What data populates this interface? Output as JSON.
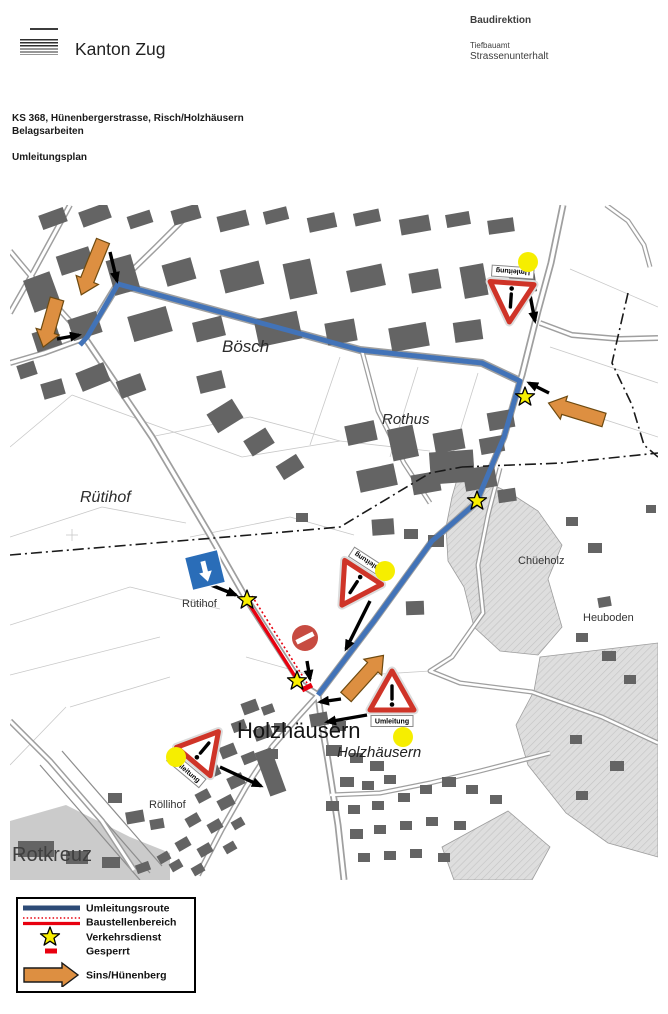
{
  "header": {
    "canton": "Kanton Zug",
    "department": "Baudirektion",
    "office_line1": "Tiefbauamt",
    "office_line2": "Strassenunterhalt"
  },
  "title": {
    "line1": "KS 368, Hünenbergerstrasse, Risch/Holzhäusern",
    "line2": "Belagsarbeiten",
    "subtitle": "Umleitungsplan"
  },
  "map": {
    "board_text": "Umleitung",
    "colors": {
      "route_blue": "#4273b8",
      "signal_red": "#e8000f",
      "triangle_red": "#cf3428",
      "no_entry_red": "#c74b41",
      "star_yellow": "#f9ef00",
      "dot_yellow": "#f6ee00",
      "arrow_orange": "#dd8f41",
      "building_gray": "#646464"
    },
    "place_labels": [
      {
        "text": "Bösch",
        "x": 212,
        "y": 147,
        "size": 17,
        "italic": true,
        "color": "#2b2b2b"
      },
      {
        "text": "Rothus",
        "x": 372,
        "y": 219,
        "size": 15,
        "italic": true,
        "color": "#2b2b2b"
      },
      {
        "text": "Rütihof",
        "x": 70,
        "y": 297,
        "size": 16,
        "italic": true,
        "color": "#2b2b2b"
      },
      {
        "text": "Rütihof",
        "x": 172,
        "y": 402,
        "size": 11,
        "italic": false,
        "color": "#333333"
      },
      {
        "text": "Chüeholz",
        "x": 508,
        "y": 359,
        "size": 11,
        "italic": false,
        "color": "#333333"
      },
      {
        "text": "Heuboden",
        "x": 573,
        "y": 416,
        "size": 11,
        "italic": false,
        "color": "#333333"
      },
      {
        "text": "Holzhäusern",
        "x": 227,
        "y": 533,
        "size": 22,
        "italic": false,
        "color": "#141414"
      },
      {
        "text": "Holzhäusern",
        "x": 327,
        "y": 552,
        "size": 15,
        "italic": true,
        "color": "#222222"
      },
      {
        "text": "Röllihof",
        "x": 139,
        "y": 603,
        "size": 11,
        "italic": false,
        "color": "#333333"
      },
      {
        "text": "Rotkreuz",
        "x": 2,
        "y": 656,
        "size": 20,
        "italic": false,
        "color": "#3f3f3f"
      }
    ],
    "route": {
      "points": "70,140 77,132 108,79 350,145 472,158 510,176 494,232 466,298 422,336 364,416 308,490",
      "width": 5
    },
    "construction": {
      "solid": [
        238,
        397,
        293,
        484
      ],
      "dotted": [
        242,
        391,
        297,
        478
      ]
    },
    "closed_marker": [
      292,
      485,
      302,
      480
    ],
    "no_entry": {
      "x": 295,
      "y": 433,
      "r": 13,
      "bar_rot": -27
    },
    "stars": [
      {
        "x": 515,
        "y": 192
      },
      {
        "x": 467,
        "y": 296
      },
      {
        "x": 237,
        "y": 395
      },
      {
        "x": 287,
        "y": 476
      }
    ],
    "yellow_dots": [
      {
        "x": 518,
        "y": 57
      },
      {
        "x": 375,
        "y": 366
      },
      {
        "x": 393,
        "y": 532
      },
      {
        "x": 166,
        "y": 552
      }
    ],
    "orange_arrows": [
      {
        "x": 93,
        "y": 36,
        "angle": 112,
        "len": 58
      },
      {
        "x": 47,
        "y": 94,
        "angle": 106,
        "len": 50
      },
      {
        "x": 594,
        "y": 215,
        "angle": 197,
        "len": 58
      },
      {
        "x": 336,
        "y": 492,
        "angle": -48,
        "len": 56
      }
    ],
    "black_arrows": [
      [
        100,
        47,
        107,
        76
      ],
      [
        47,
        134,
        69,
        130
      ],
      [
        520,
        90,
        525,
        116
      ],
      [
        539,
        188,
        519,
        178
      ],
      [
        360,
        396,
        336,
        444
      ],
      [
        297,
        456,
        300,
        474
      ],
      [
        196,
        378,
        226,
        390
      ],
      [
        331,
        494,
        310,
        497
      ],
      [
        357,
        510,
        317,
        517
      ],
      [
        210,
        562,
        251,
        581
      ]
    ],
    "warning_signs": [
      {
        "x": 501,
        "y": 93,
        "rot": 184
      },
      {
        "x": 345,
        "y": 380,
        "rot": 213
      },
      {
        "x": 382,
        "y": 490,
        "rot": 0
      },
      {
        "x": 193,
        "y": 545,
        "rot": 40
      }
    ],
    "blue_sign": {
      "x": 195,
      "y": 365,
      "size": 34,
      "rot": -14,
      "color": "#2a6db8"
    }
  },
  "legend": {
    "items": [
      {
        "symbol": "route-line",
        "label": "Umleitungsroute"
      },
      {
        "symbol": "construction-line",
        "label": "Baustellenbereich"
      },
      {
        "symbol": "traffic-star",
        "label": "Verkehrsdienst"
      },
      {
        "symbol": "closed-dash",
        "label": "Gesperrt"
      },
      {
        "symbol": "direction-arrow",
        "label": "Sins/Hünenberg"
      }
    ],
    "colors": {
      "route": "#2d4b77",
      "red": "#e8000f",
      "star": "#f9ef00",
      "orange": "#dd8f41"
    }
  }
}
